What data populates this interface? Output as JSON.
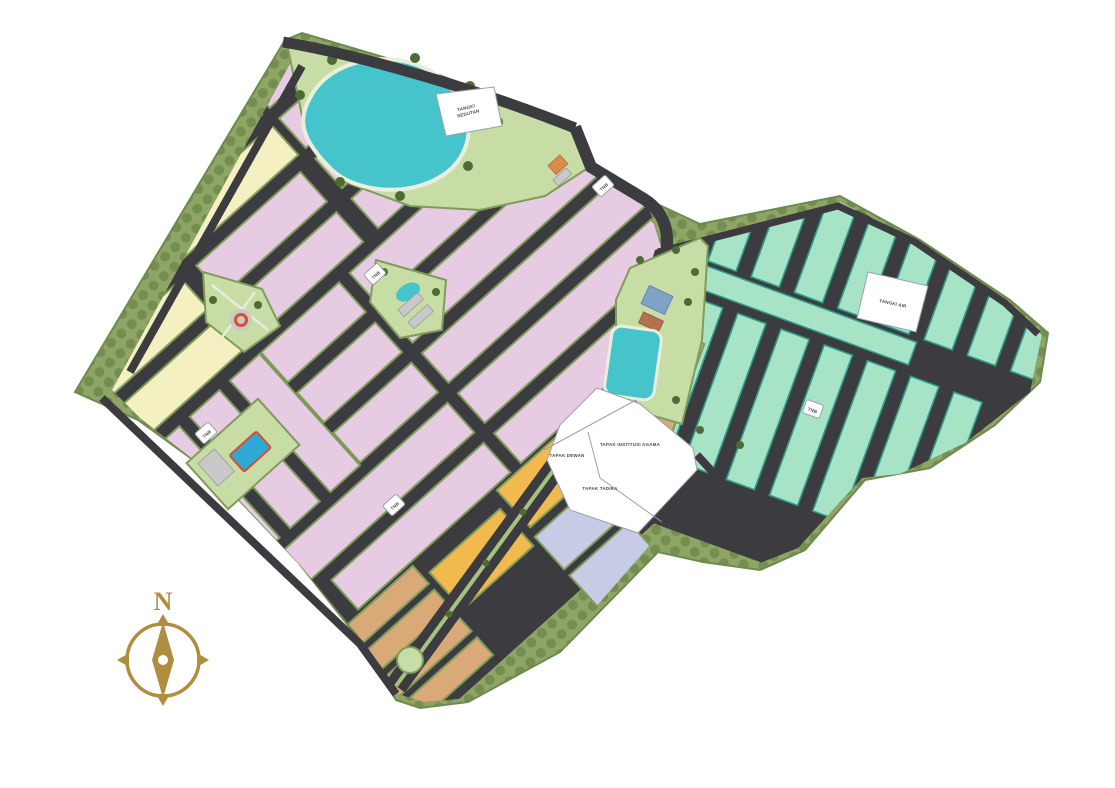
{
  "labels": {
    "tangki_sedutan_line1": "TANGKI",
    "tangki_sedutan_line2": "SEDUTAN",
    "tangki_air": "TANGKI AIR",
    "tapak_institusi_agama": "TAPAK INSTITUSI AGAMA",
    "tapak_dewan": "TAPAK DEWAN",
    "tapak_tadika": "TAPAK TADIKA",
    "tnb": "TNB",
    "compass_north": "N"
  },
  "colors": {
    "background": "#ffffff",
    "buffer": "#8fa565",
    "buffer_tree": "#6f8a4c",
    "park_green": "#c8dca6",
    "verge_green": "#7f9c5a",
    "tree_green": "#4e6b35",
    "road_dark": "#3b3b40",
    "road_median": "#a7c27f",
    "lake_teal": "#45c4cc",
    "lake_stroke": "#e8efdc",
    "house_pink": "#e7cbe3",
    "house_cream": "#f4f0c1",
    "house_mint": "#a7e4c6",
    "mint_stroke": "#2e9b88",
    "house_orange": "#f2b94f",
    "house_periwinkle": "#c8cbe6",
    "house_tan": "#d9a978",
    "parcel_white": "#ffffff",
    "parcel_line": "#9aa0a8",
    "label_ink": "#4a4a52",
    "compass_gold": "#b18d3f",
    "pool_blue": "#2fa8d5",
    "accent_red": "#d94f2b",
    "building_gray": "#c9c9c9",
    "roof_orange": "#d98c4a",
    "roof_blue": "#7fa3c6",
    "roof_brown": "#b5714d"
  }
}
